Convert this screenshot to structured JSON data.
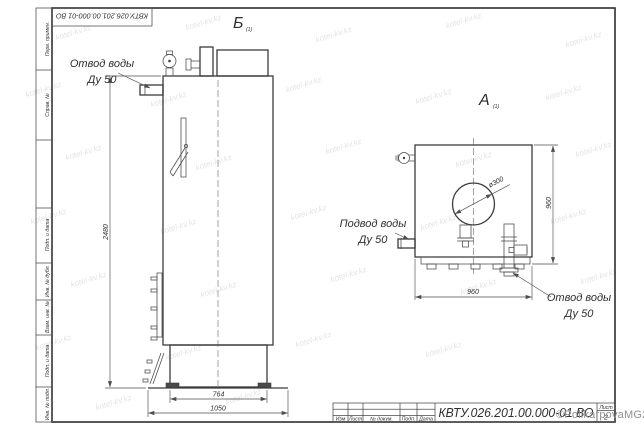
{
  "page": {
    "doc_number": "КВТУ.026.201.00.000-01 ВО",
    "sheet_label": "Лист",
    "sheet_number": "2"
  },
  "frame": {
    "left_strip_cells": [
      "Перв. примен.",
      "Справ. №",
      "Подп. и дата",
      "Инв. № дубл.",
      "Взам. инв. №",
      "Подп. и дата",
      "Инв. № подл."
    ],
    "title_columns": [
      "Изм",
      "Лист",
      "№ докум.",
      "Подп.",
      "Дата"
    ]
  },
  "views": {
    "side": {
      "label": "Б",
      "scale_note": "(1)"
    },
    "front": {
      "label": "А",
      "scale_note": "(1)"
    }
  },
  "callouts": {
    "outlet_top": {
      "line1": "Отвод воды",
      "line2": "Ду 50"
    },
    "inlet": {
      "line1": "Подвод воды",
      "line2": "Ду 50"
    },
    "outlet_bottom": {
      "line1": "Отвод воды",
      "line2": "Ду 50"
    }
  },
  "dimensions": {
    "height": "2480",
    "pedestal_width": "764",
    "base_width": "1050",
    "front_height": "960",
    "front_width": "960",
    "hatch_diameter": "ø300"
  },
  "watermark": {
    "tile": "kotel-kv.kz",
    "signature": "©PolikarpovaMG2021"
  },
  "colors": {
    "line": "#3b3b3b",
    "dim_line": "#4d4d4d",
    "watermark_tile": "#e4e4e4",
    "watermark_signature": "#8f8f8f"
  }
}
